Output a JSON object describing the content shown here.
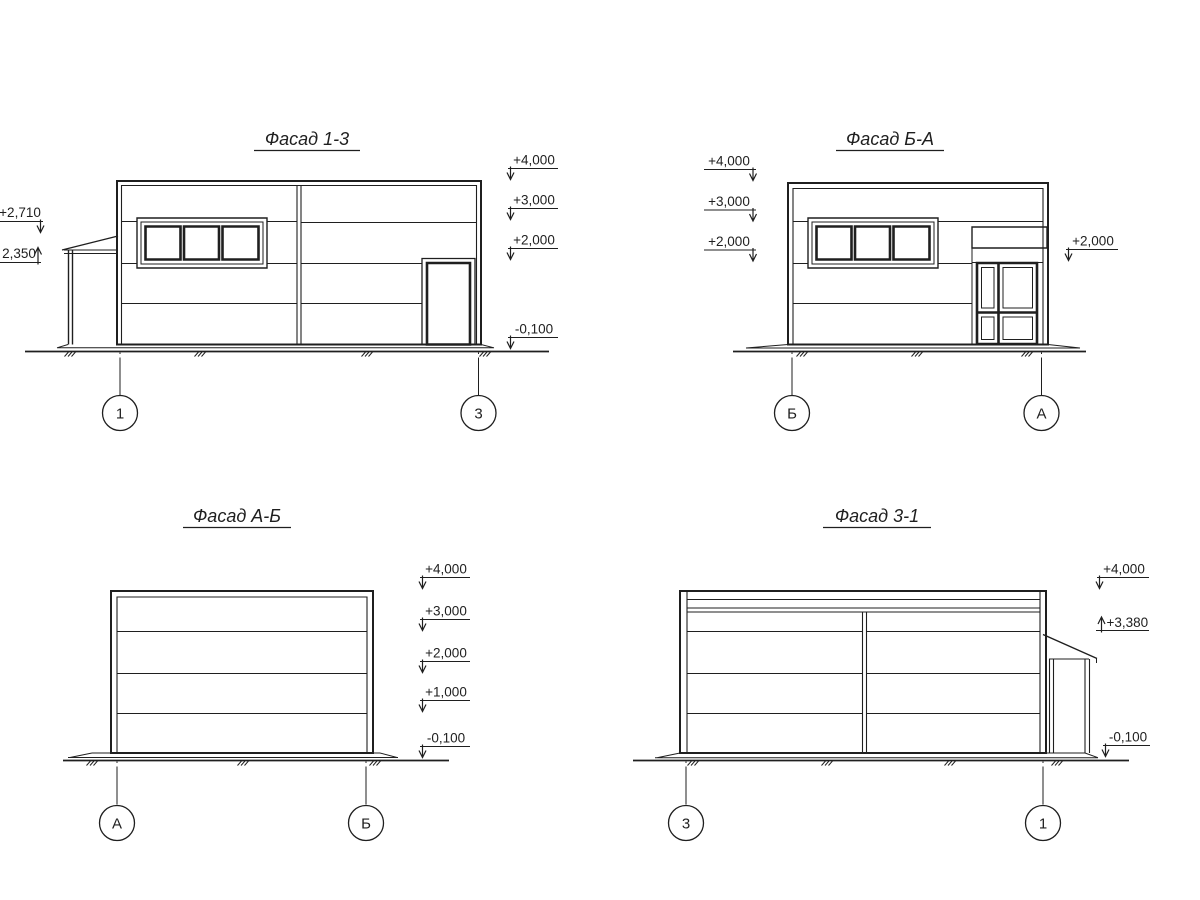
{
  "colors": {
    "ink": "#1f1f1f",
    "paper": "#ffffff"
  },
  "facades": [
    {
      "title": "Фасад 1-3",
      "axes": {
        "left": "1",
        "right": "3"
      },
      "elevations": {
        "left": [
          "+2,710",
          "2,350"
        ],
        "right": [
          "+4,000",
          "+3,000",
          "+2,000",
          "-0,100"
        ]
      }
    },
    {
      "title": "Фасад Б-А",
      "axes": {
        "left": "Б",
        "right": "А"
      },
      "elevations": {
        "left": [
          "+4,000",
          "+3,000",
          "+2,000"
        ],
        "right": [
          "+2,000"
        ]
      }
    },
    {
      "title": "Фасад А-Б",
      "axes": {
        "left": "А",
        "right": "Б"
      },
      "elevations": {
        "right": [
          "+4,000",
          "+3,000",
          "+2,000",
          "+1,000",
          "-0,100"
        ]
      }
    },
    {
      "title": "Фасад 3-1",
      "axes": {
        "left": "3",
        "right": "1"
      },
      "elevations": {
        "right": [
          "+4,000",
          "+3,380",
          "-0,100"
        ]
      }
    }
  ]
}
